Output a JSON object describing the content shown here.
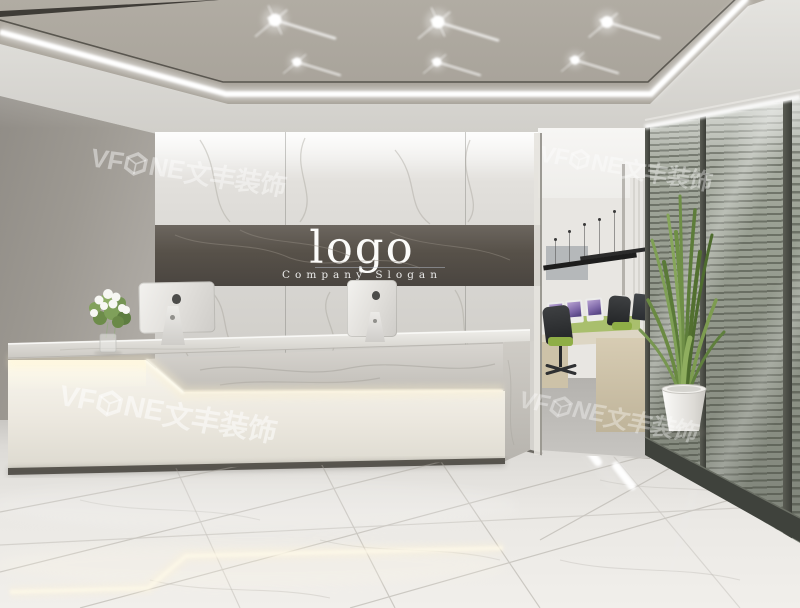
{
  "watermark": {
    "brand_prefix": "VF",
    "brand_suffix": "NE",
    "brand_cjk": "文丰装饰",
    "full_text": "VF ONE文丰装饰"
  },
  "wall_sign": {
    "logo_text": "logo",
    "slogan_text": "Company Slogan"
  },
  "palette": {
    "ceiling_greige": "#a9a49b",
    "led_strip_white": "#ffffff",
    "left_wall_gray": "#9d9992",
    "marble_light": "#e3e1dd",
    "marble_dark_band": "#57514a",
    "desk_panel_white": "#f0eee6",
    "under_counter_glow": "#fff3cf",
    "floor_marble": "#eae8e4",
    "glass_blinds_olive": "#9ba194",
    "glass_frame_dark": "#3c3e38",
    "plant_green": "#6f8f45",
    "office_green_accent": "#a9bf6d",
    "office_chair_seat_green": "#8fae46",
    "monitor_screen_purple": "#7e68a8",
    "office_wood": "#cdc2a8"
  }
}
